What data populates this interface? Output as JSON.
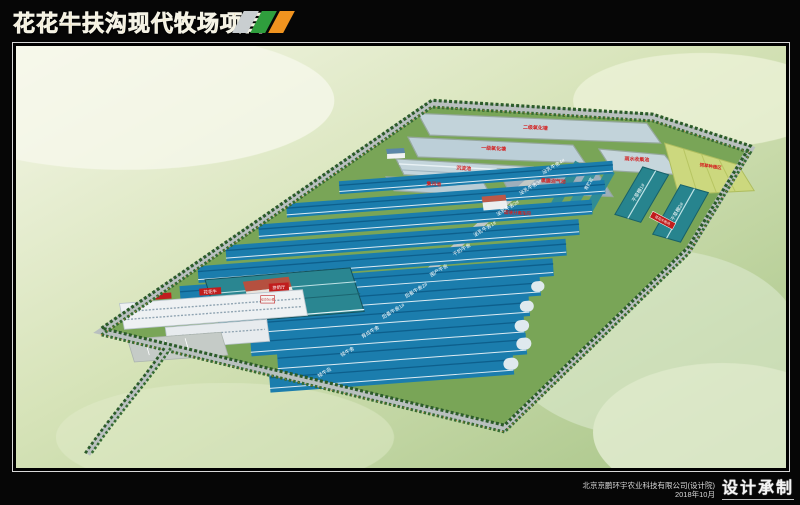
{
  "header": {
    "title": "花花牛扶沟现代牧场项目"
  },
  "footer": {
    "company": "北京京鹏环宇农业科技有限公司(设计院)",
    "date": "2018年10月",
    "credit": "设计承制"
  },
  "site": {
    "ponds": [
      "二级氧化塘",
      "一级氧化塘",
      "沉淀池",
      "集污池",
      "雨水收集池",
      "黑膜沼气池"
    ],
    "separation": "固液分离车间",
    "crops": "饲草种植区",
    "silage": "青贮窖",
    "sheds": [
      "干草棚1#",
      "干草棚2#"
    ],
    "barns": [
      "泌乳牛舍4#",
      "泌乳牛舍3#",
      "泌乳牛舍2#",
      "泌乳牛舍1#",
      "干奶牛舍",
      "围产牛舍",
      "后备牛舍2#",
      "后备牛舍1#",
      "育成牛舍",
      "犊牛舍",
      "犊牛岛"
    ],
    "parlor": "挤奶厅",
    "office_sign": "花花牛",
    "office_sign2": "综合办公楼",
    "gate": "花花牛牧场"
  },
  "colors": {
    "title_gold": "#d9a83c",
    "logo_silver": "#c9ced0",
    "logo_green": "#2f9e3d",
    "logo_orange": "#f0931f",
    "barn_roof": "#1b7dad",
    "barn_ridge": "#0d5f8c",
    "shed_teal": "#27848e",
    "pond_blue": "#c2d3da",
    "label_red": "#d42020",
    "sign_red": "#c11d1d",
    "road_gray": "#b9c0bf",
    "tree_green": "#2b5b29",
    "field_green": "#79a557"
  }
}
